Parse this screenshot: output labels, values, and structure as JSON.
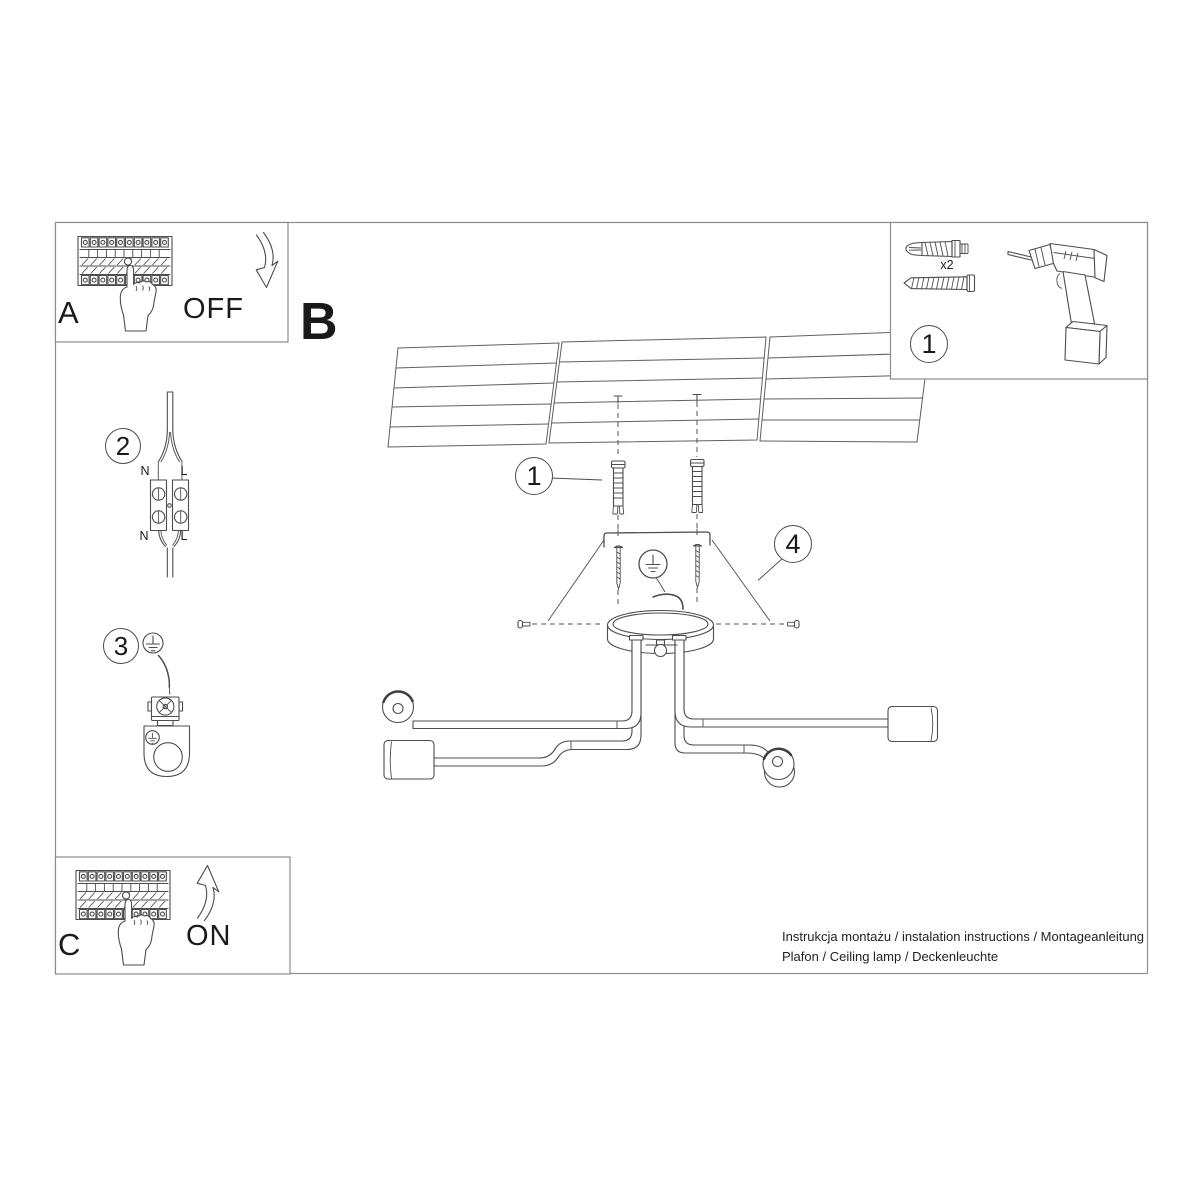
{
  "document": {
    "footer": {
      "line1": "Instrukcja montażu / instalation instructions / Montageanleitung",
      "line2": "Plafon / Ceiling lamp / Deckenleuchte"
    }
  },
  "steps": {
    "a": {
      "label": "A",
      "switch_state": "OFF"
    },
    "b": {
      "label": "B"
    },
    "c": {
      "label": "C",
      "switch_state": "ON"
    },
    "wiring": {
      "number": "2",
      "terminal_labels": {
        "top_n": "N",
        "top_l": "L",
        "bottom_n": "N",
        "bottom_l": "L"
      }
    },
    "grounding": {
      "number": "3"
    },
    "callout_anchor": "1",
    "callout_canopy": "4"
  },
  "parts_box": {
    "number": "1",
    "anchor_quantity": "x2"
  },
  "colors": {
    "background": "#ffffff",
    "line": "#4d4d4d",
    "frame": "#8c8c8c",
    "ceiling_line": "#5f5f5f",
    "text": "#1a1a1a"
  }
}
